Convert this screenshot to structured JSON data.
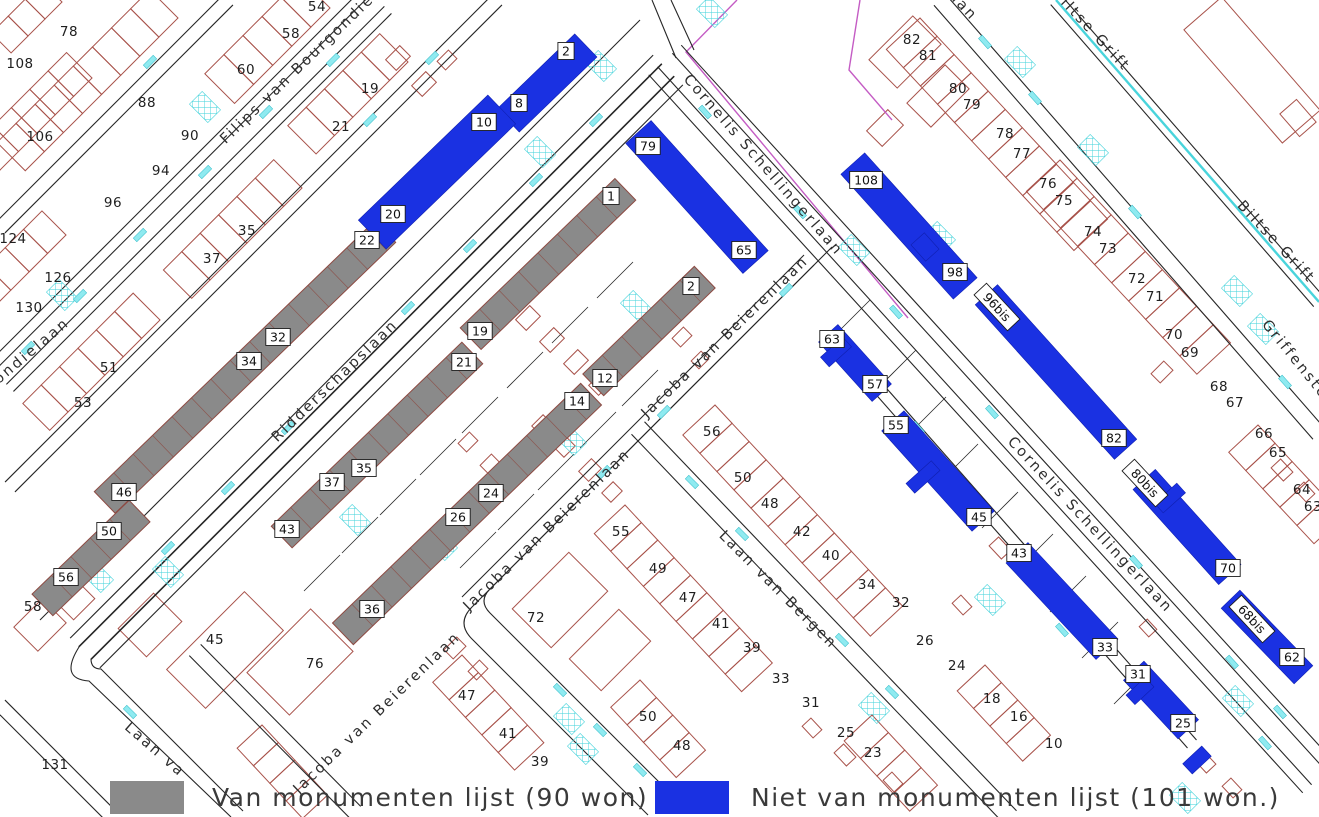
{
  "legend": {
    "items": [
      {
        "id": "monument",
        "label": "Van monumenten lijst (90 won)",
        "color": "#8a8a8a"
      },
      {
        "id": "non_monument",
        "label": "Niet van monumenten lijst (101 won.)",
        "color": "#1a31e2"
      }
    ]
  },
  "map": {
    "colors": {
      "monument_fill": "#8a8a8a",
      "monument_outline": "#8d4a42",
      "non_monument_fill": "#1a31e2",
      "parcel_outline": "#a8524a",
      "street_line": "#262626",
      "water": "#49d4dc",
      "cyan_fill": "#8feaf0",
      "boundary": "#c45cc4",
      "text": "#1f1f1f"
    },
    "street_labels": [
      {
        "text": "Filips van Bourgondielaan",
        "x": 315,
        "y": 58,
        "rot": -44
      },
      {
        "text": "gondielaan",
        "x": 30,
        "y": 358,
        "rot": -40
      },
      {
        "text": "Ridderschapslaan",
        "x": 338,
        "y": 384,
        "rot": -44
      },
      {
        "text": "Jacoba van Beierenlaan",
        "x": 728,
        "y": 340,
        "rot": -44
      },
      {
        "text": "Jacoba van Beierenlaan",
        "x": 550,
        "y": 533,
        "rot": -44
      },
      {
        "text": "Jacoba van Beierenlaan",
        "x": 380,
        "y": 716,
        "rot": -44
      },
      {
        "text": "Laan van Bergen",
        "x": 775,
        "y": 593,
        "rot": 45
      },
      {
        "text": "Laan va",
        "x": 152,
        "y": 753,
        "rot": 41
      },
      {
        "text": "Cornelis Schellingerlaan",
        "x": 760,
        "y": 168,
        "rot": 49
      },
      {
        "text": "Cornelis Schellingerlaan",
        "x": 1087,
        "y": 528,
        "rot": 47
      },
      {
        "text": "Biltse Grift",
        "x": 1088,
        "y": 33,
        "rot": 47
      },
      {
        "text": "Biltse Grift",
        "x": 1273,
        "y": 245,
        "rot": 47
      },
      {
        "text": "Griffensteyn",
        "x": 1299,
        "y": 371,
        "rot": 51
      },
      {
        "text": "aan",
        "x": 960,
        "y": 9,
        "rot": 47
      }
    ],
    "monument_building_labels": [
      {
        "text": "1",
        "x": 611,
        "y": 196
      },
      {
        "text": "19",
        "x": 480,
        "y": 331
      },
      {
        "text": "21",
        "x": 464,
        "y": 362
      },
      {
        "text": "35",
        "x": 364,
        "y": 468
      },
      {
        "text": "37",
        "x": 332,
        "y": 482
      },
      {
        "text": "43",
        "x": 287,
        "y": 529
      },
      {
        "text": "2",
        "x": 691,
        "y": 286
      },
      {
        "text": "12",
        "x": 605,
        "y": 378
      },
      {
        "text": "14",
        "x": 577,
        "y": 401
      },
      {
        "text": "24",
        "x": 491,
        "y": 493
      },
      {
        "text": "26",
        "x": 458,
        "y": 517
      },
      {
        "text": "36",
        "x": 372,
        "y": 609
      },
      {
        "text": "22",
        "x": 367,
        "y": 240
      },
      {
        "text": "32",
        "x": 278,
        "y": 337
      },
      {
        "text": "34",
        "x": 249,
        "y": 361
      },
      {
        "text": "46",
        "x": 124,
        "y": 492
      },
      {
        "text": "50",
        "x": 109,
        "y": 531
      },
      {
        "text": "56",
        "x": 66,
        "y": 577
      }
    ],
    "non_monument_building_labels": [
      {
        "text": "2",
        "x": 566,
        "y": 51
      },
      {
        "text": "8",
        "x": 519,
        "y": 103
      },
      {
        "text": "10",
        "x": 484,
        "y": 122
      },
      {
        "text": "20",
        "x": 393,
        "y": 214
      },
      {
        "text": "79",
        "x": 648,
        "y": 146
      },
      {
        "text": "65",
        "x": 744,
        "y": 250
      },
      {
        "text": "108",
        "x": 866,
        "y": 180
      },
      {
        "text": "98",
        "x": 955,
        "y": 272
      },
      {
        "text": "96bis",
        "x": 997,
        "y": 307,
        "rot": 47
      },
      {
        "text": "82",
        "x": 1114,
        "y": 438
      },
      {
        "text": "63",
        "x": 832,
        "y": 339
      },
      {
        "text": "57",
        "x": 875,
        "y": 384
      },
      {
        "text": "55",
        "x": 896,
        "y": 425
      },
      {
        "text": "45",
        "x": 979,
        "y": 517
      },
      {
        "text": "80bis",
        "x": 1145,
        "y": 483,
        "rot": 47
      },
      {
        "text": "70",
        "x": 1228,
        "y": 568
      },
      {
        "text": "43",
        "x": 1019,
        "y": 553
      },
      {
        "text": "33",
        "x": 1105,
        "y": 647
      },
      {
        "text": "68bis",
        "x": 1252,
        "y": 619,
        "rot": 47
      },
      {
        "text": "62",
        "x": 1292,
        "y": 657
      },
      {
        "text": "31",
        "x": 1138,
        "y": 674
      },
      {
        "text": "25",
        "x": 1183,
        "y": 723
      }
    ],
    "house_numbers": [
      {
        "text": "78",
        "x": 69,
        "y": 31
      },
      {
        "text": "108",
        "x": 20,
        "y": 63
      },
      {
        "text": "88",
        "x": 147,
        "y": 102
      },
      {
        "text": "106",
        "x": 40,
        "y": 136
      },
      {
        "text": "90",
        "x": 190,
        "y": 135
      },
      {
        "text": "94",
        "x": 161,
        "y": 170
      },
      {
        "text": "96",
        "x": 113,
        "y": 202
      },
      {
        "text": "124",
        "x": 13,
        "y": 238
      },
      {
        "text": "126",
        "x": 58,
        "y": 277
      },
      {
        "text": "130",
        "x": 29,
        "y": 307
      },
      {
        "text": "51",
        "x": 109,
        "y": 367
      },
      {
        "text": "53",
        "x": 83,
        "y": 402
      },
      {
        "text": "54",
        "x": 317,
        "y": 6
      },
      {
        "text": "58",
        "x": 291,
        "y": 33
      },
      {
        "text": "60",
        "x": 246,
        "y": 69
      },
      {
        "text": "19",
        "x": 370,
        "y": 88
      },
      {
        "text": "21",
        "x": 341,
        "y": 126
      },
      {
        "text": "35",
        "x": 247,
        "y": 230
      },
      {
        "text": "37",
        "x": 212,
        "y": 258
      },
      {
        "text": "58",
        "x": 33,
        "y": 606
      },
      {
        "text": "45",
        "x": 215,
        "y": 639
      },
      {
        "text": "76",
        "x": 315,
        "y": 663
      },
      {
        "text": "131",
        "x": 55,
        "y": 764
      },
      {
        "text": "72",
        "x": 536,
        "y": 617
      },
      {
        "text": "47",
        "x": 467,
        "y": 695
      },
      {
        "text": "41",
        "x": 508,
        "y": 733
      },
      {
        "text": "39",
        "x": 540,
        "y": 761
      },
      {
        "text": "55",
        "x": 621,
        "y": 531
      },
      {
        "text": "49",
        "x": 658,
        "y": 568
      },
      {
        "text": "47",
        "x": 688,
        "y": 597
      },
      {
        "text": "41",
        "x": 721,
        "y": 623
      },
      {
        "text": "39",
        "x": 752,
        "y": 647
      },
      {
        "text": "33",
        "x": 781,
        "y": 678
      },
      {
        "text": "31",
        "x": 811,
        "y": 702
      },
      {
        "text": "25",
        "x": 846,
        "y": 732
      },
      {
        "text": "56",
        "x": 712,
        "y": 431
      },
      {
        "text": "50",
        "x": 743,
        "y": 477
      },
      {
        "text": "48",
        "x": 770,
        "y": 503
      },
      {
        "text": "42",
        "x": 802,
        "y": 531
      },
      {
        "text": "40",
        "x": 831,
        "y": 555
      },
      {
        "text": "34",
        "x": 867,
        "y": 584
      },
      {
        "text": "32",
        "x": 901,
        "y": 602
      },
      {
        "text": "26",
        "x": 925,
        "y": 640
      },
      {
        "text": "24",
        "x": 957,
        "y": 665
      },
      {
        "text": "50",
        "x": 648,
        "y": 716
      },
      {
        "text": "48",
        "x": 682,
        "y": 745
      },
      {
        "text": "23",
        "x": 873,
        "y": 752
      },
      {
        "text": "18",
        "x": 992,
        "y": 698
      },
      {
        "text": "16",
        "x": 1019,
        "y": 716
      },
      {
        "text": "10",
        "x": 1054,
        "y": 743
      },
      {
        "text": "82",
        "x": 912,
        "y": 39
      },
      {
        "text": "81",
        "x": 928,
        "y": 55
      },
      {
        "text": "80",
        "x": 958,
        "y": 88
      },
      {
        "text": "79",
        "x": 972,
        "y": 104
      },
      {
        "text": "78",
        "x": 1005,
        "y": 133
      },
      {
        "text": "77",
        "x": 1022,
        "y": 153
      },
      {
        "text": "76",
        "x": 1048,
        "y": 183
      },
      {
        "text": "75",
        "x": 1064,
        "y": 200
      },
      {
        "text": "74",
        "x": 1093,
        "y": 231
      },
      {
        "text": "73",
        "x": 1108,
        "y": 248
      },
      {
        "text": "72",
        "x": 1137,
        "y": 278
      },
      {
        "text": "71",
        "x": 1155,
        "y": 296
      },
      {
        "text": "70",
        "x": 1174,
        "y": 334
      },
      {
        "text": "69",
        "x": 1190,
        "y": 352
      },
      {
        "text": "68",
        "x": 1219,
        "y": 386
      },
      {
        "text": "67",
        "x": 1235,
        "y": 402
      },
      {
        "text": "66",
        "x": 1264,
        "y": 433
      },
      {
        "text": "65",
        "x": 1278,
        "y": 452
      },
      {
        "text": "64",
        "x": 1302,
        "y": 489
      },
      {
        "text": "63",
        "x": 1313,
        "y": 506
      }
    ]
  }
}
